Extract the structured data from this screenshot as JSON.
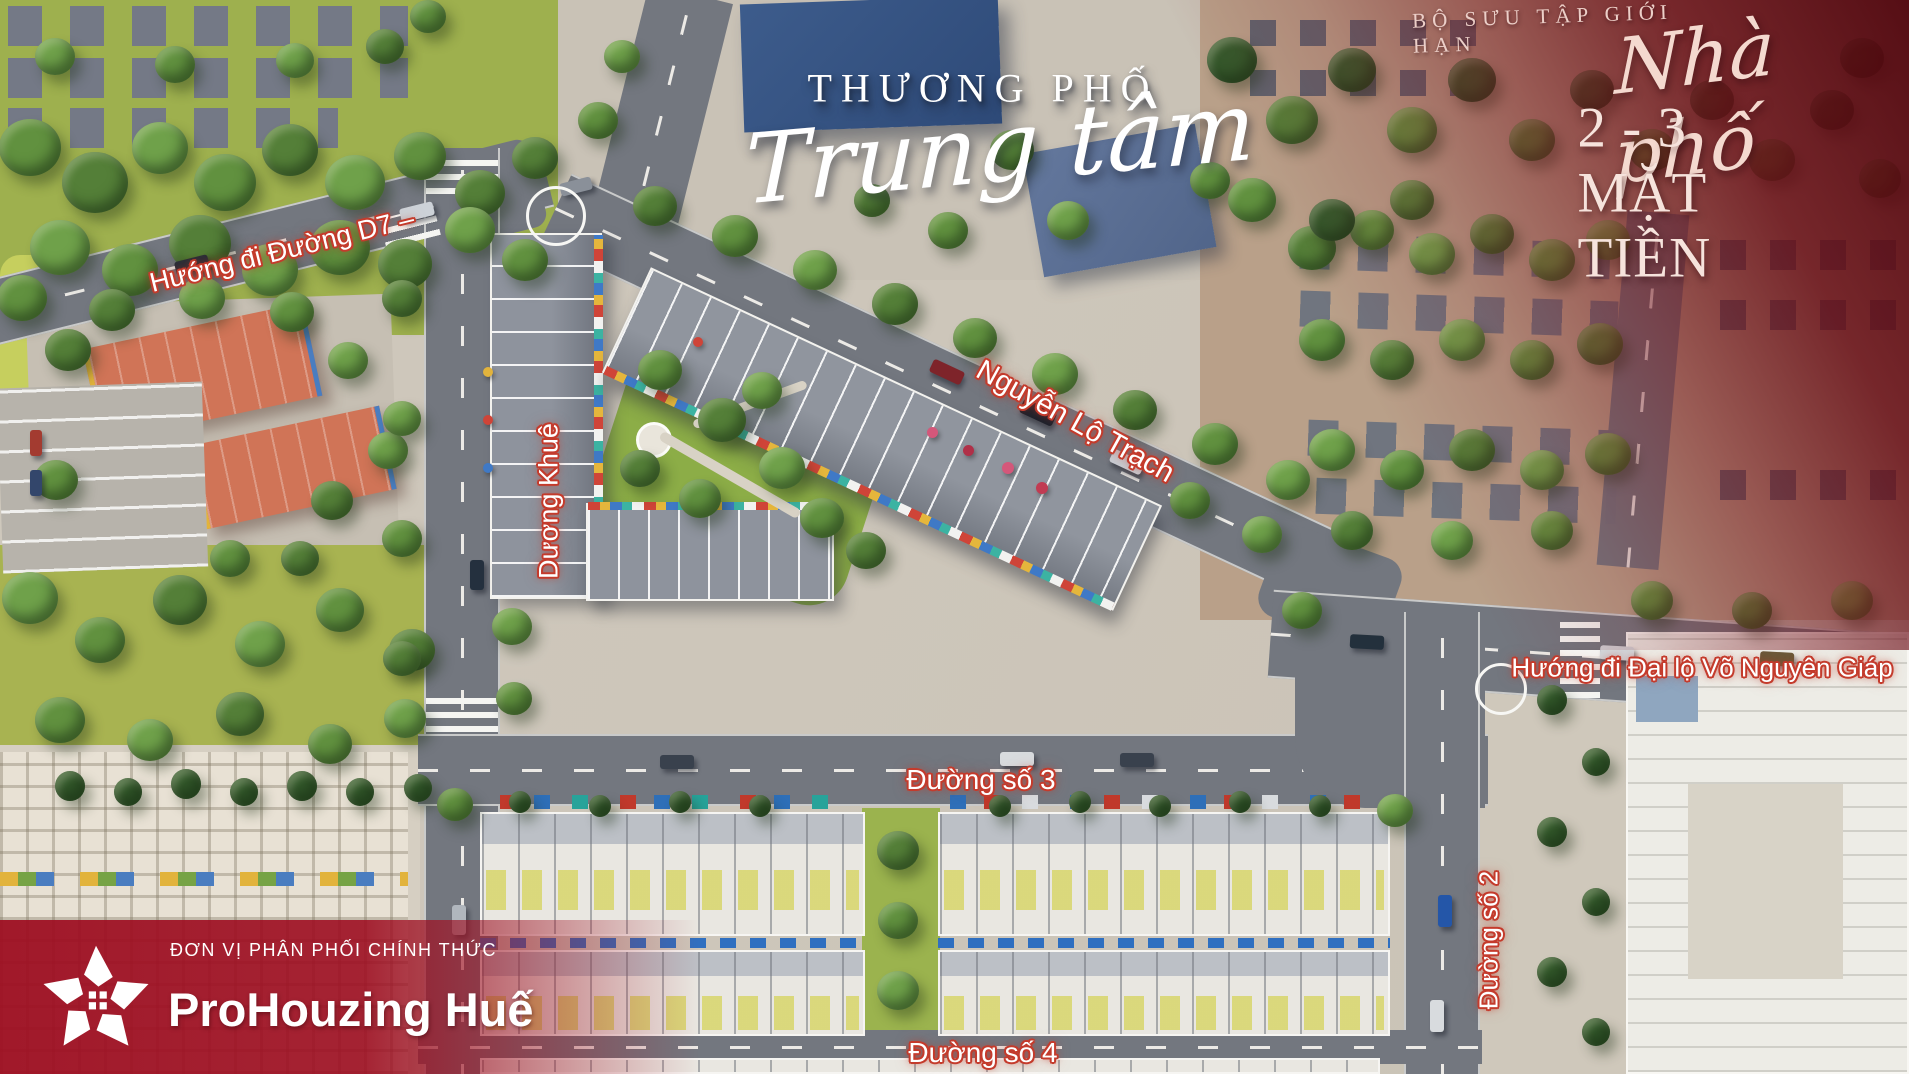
{
  "hero": {
    "line1": "THƯƠNG PHỐ",
    "line2": "Trung tâm"
  },
  "collection": {
    "tagline": "BỘ SƯU TẬP GIỚI HẠN",
    "script": "Nhà phố",
    "headline": "2 - 3 MẶT TIỀN"
  },
  "roads": {
    "d7": "Hướng đi Đường D7 –",
    "duong_khue": "Dương Khuê",
    "nguyen_lo_trach": "Nguyễn Lộ Trạch",
    "vo_nguyen_giap": "Hướng đi Đại lộ Võ Nguyên Giáp",
    "so_3": "Đường số 3",
    "so_2": "Đường số 2",
    "so_4": "Đường số 4"
  },
  "branding": {
    "tagline": "ĐƠN VỊ PHÂN PHỐI CHÍNH THỨC",
    "name": "ProHouzing Huế"
  },
  "colors": {
    "label_stroke": "#c43b2c",
    "banner_red": "#9d0e21",
    "overlay_red": "#500610",
    "accent_cream": "#f6e3dc"
  }
}
